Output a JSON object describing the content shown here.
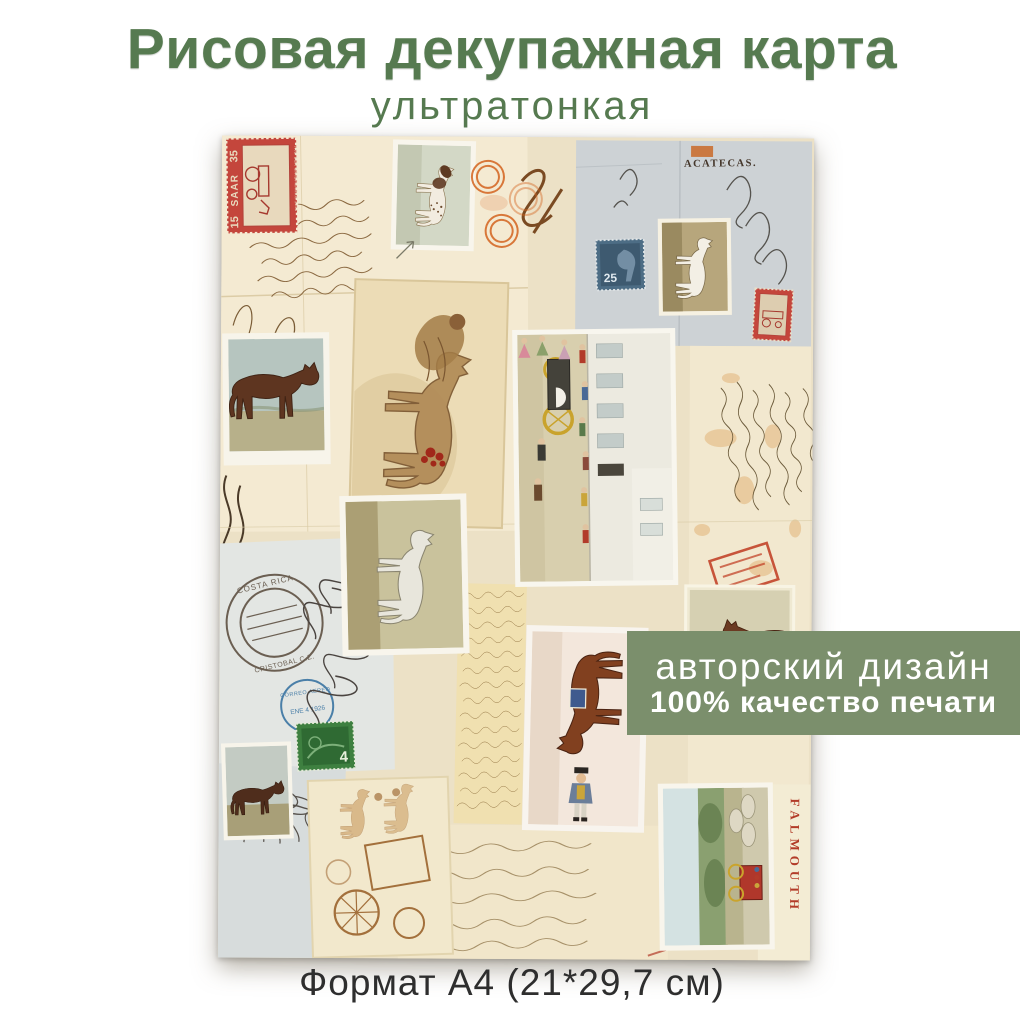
{
  "product": {
    "title": "Рисовая декупажная карта",
    "subtitle": "ультратонкая",
    "format": "Формат А4 (21*29,7 см)"
  },
  "banner": {
    "line1": "авторский дизайн",
    "line2": "100% качество печати"
  },
  "colors": {
    "title_green": "#567a50",
    "banner_green": "#7b8f6c",
    "caption_dark": "#2e2e2e",
    "paper_cream": "#ece1c6",
    "envelope_gray": "#cdd2d5",
    "stamp_red": "#c4463c",
    "stamp_blue": "#4d6d85",
    "stamp_green": "#3e8040",
    "postmark_orange": "#d4641f"
  },
  "collage": {
    "envelope_zacatecas": "ACATECAS.",
    "falmouth": "FALMOUTH",
    "stamp_saar": {
      "value_left": "15",
      "name": "SAAR",
      "value_right": "35",
      "caption": "TAG DER BRIEFMARKE 1950"
    },
    "stamp_blue_value": "25",
    "stamp_green_value": "4",
    "postmark_costa_rica": "COSTA RICA",
    "postmark_cristobal": "CRISTOBAL C.Z.",
    "postmark_correo": "CORREO AEREO",
    "postmark_date": "ENE 4 1926",
    "address_number": "213"
  }
}
